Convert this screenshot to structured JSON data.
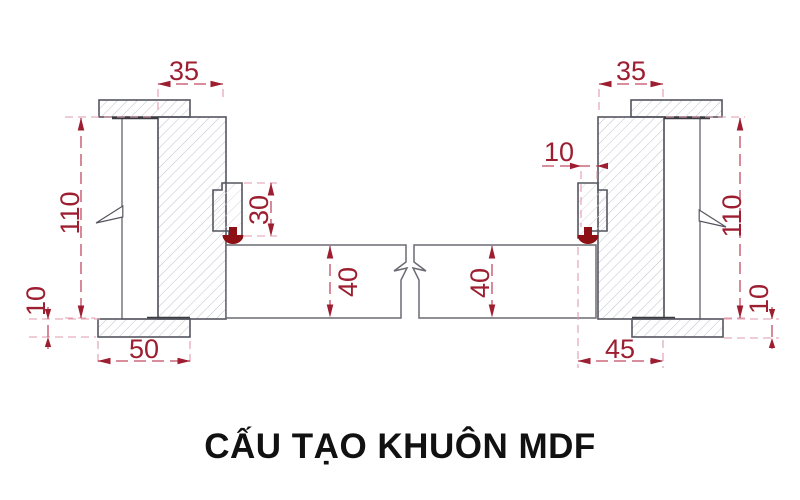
{
  "title": {
    "text": "CẤU TẠO KHUÔN MDF"
  },
  "diagram": {
    "description_units": "mm",
    "left": {
      "top_width": "35",
      "height": "110",
      "stop_depth": "30",
      "panel_thickness": "40",
      "casing_thickness": "10",
      "casing_width": "50"
    },
    "right": {
      "stop_width": "10",
      "top_width": "35",
      "height": "110",
      "panel_thickness": "40",
      "casing_thickness": "10",
      "casing_width": "45"
    },
    "colors": {
      "dimension_line": "#c14a62",
      "extension_line": "#e09aac",
      "dimension_text": "#9c1e30",
      "outline": "#55555f",
      "hatch": "#bfbfcc",
      "masonry_green": "#44cf44",
      "gasket_red": "#8c1014",
      "title_color": "#111111",
      "background": "#ffffff"
    }
  }
}
